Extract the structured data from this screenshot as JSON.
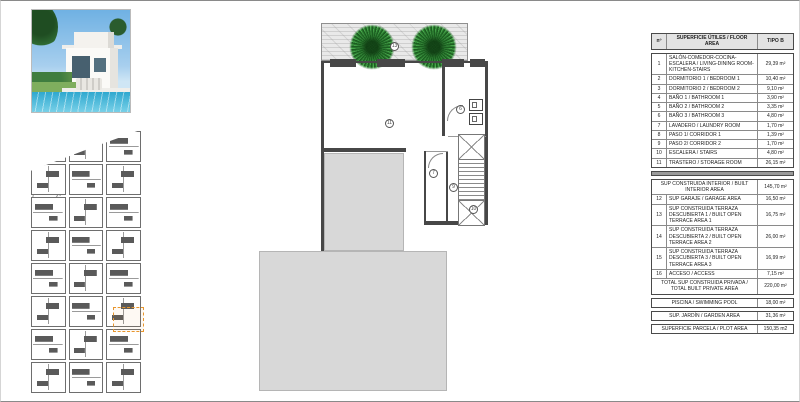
{
  "sheet": {
    "kind": "architectural floor plan sheet"
  },
  "area_table": {
    "header": {
      "num": "nº",
      "desc": "SUPERFICIE ÚTILES / FLOOR AREA",
      "type": "TIPO B"
    },
    "rows": [
      {
        "num": "1",
        "label": "SALÓN-COMEDOR-COCINA-ESCALERA / LIVING-DINING ROOM-KITCHEN-STAIRS",
        "value": "29,39 m²"
      },
      {
        "num": "2",
        "label": "DORMITORIO 1 / BEDROOM 1",
        "value": "10,40 m²"
      },
      {
        "num": "3",
        "label": "DORMITORIO 2 / BEDROOM 2",
        "value": "9,10 m²"
      },
      {
        "num": "4",
        "label": "BAÑO 1 / BATHROOM 1",
        "value": "3,90 m²"
      },
      {
        "num": "5",
        "label": "BAÑO 2 / BATHROOM 2",
        "value": "3,35 m²"
      },
      {
        "num": "6",
        "label": "BAÑO 3 / BATHROOM 3",
        "value": "4,80 m²"
      },
      {
        "num": "7",
        "label": "LAVADERO / LAUNDRY ROOM",
        "value": "1,70 m²"
      },
      {
        "num": "8",
        "label": "PASO 1/ CORRIDOR 1",
        "value": "1,39 m²"
      },
      {
        "num": "9",
        "label": "PASO 2/ CORRIDOR 2",
        "value": "1,70 m²"
      },
      {
        "num": "10",
        "label": "ESCALERA / STAIRS",
        "value": "4,80 m²"
      },
      {
        "num": "11",
        "label": "TRASTERO / STORAGE ROOM",
        "value": "26,15 m²"
      }
    ],
    "summary": {
      "interior": {
        "label": "SUP CONSTRUIDA INTERIOR / BUILT INTERIOR AREA",
        "value": "145,70 m²"
      },
      "rows": [
        {
          "num": "12",
          "label": "SUP GARAJE / GARAGE AREA",
          "value": "16,50 m²"
        },
        {
          "num": "13",
          "label": "SUP CONSTRUIDA TERRAZA DESCUBIERTA 1 / BUILT OPEN TERRACE AREA 1",
          "value": "16,75 m²"
        },
        {
          "num": "14",
          "label": "SUP CONSTRUIDA TERRAZA DESCUBIERTA 2 / BUILT OPEN TERRACE AREA 2",
          "value": "26,00 m²"
        },
        {
          "num": "15",
          "label": "SUP CONSTRUIDA TERRAZA DESCUBIERTA 3 / BUILT OPEN TERRACE AREA 3",
          "value": "16,99 m²"
        },
        {
          "num": "16",
          "label": "ACCESO / ACCESS",
          "value": "7,15 m²"
        }
      ],
      "total": {
        "label": "TOTAL SUP CONSTRUIDA PRIVADA / TOTAL BUILT PRIVATE AREA",
        "value": "220,00 m²"
      }
    },
    "footer_rows": [
      {
        "label": "PISCINA / SWIMMING POOL",
        "value": "18,00 m²"
      },
      {
        "label": "SUP. JARDÍN / GARDEN AREA",
        "value": "31,36 m²"
      },
      {
        "label": "SUPERFICIE PARCELA / PLOT AREA",
        "value": "150,35 m2"
      }
    ]
  },
  "floor_plan": {
    "labels": {
      "terrace": "13",
      "storage": "11",
      "bathroom": "6",
      "laundry": "7",
      "corridor": "9",
      "stairs": "10"
    }
  },
  "colors": {
    "highlight_orange": "#E8962E",
    "wall_dark": "#474747",
    "fill_gray": "#D8D8D8",
    "tree_green": "#2E7D32",
    "pool_blue": "#35AFD6"
  }
}
